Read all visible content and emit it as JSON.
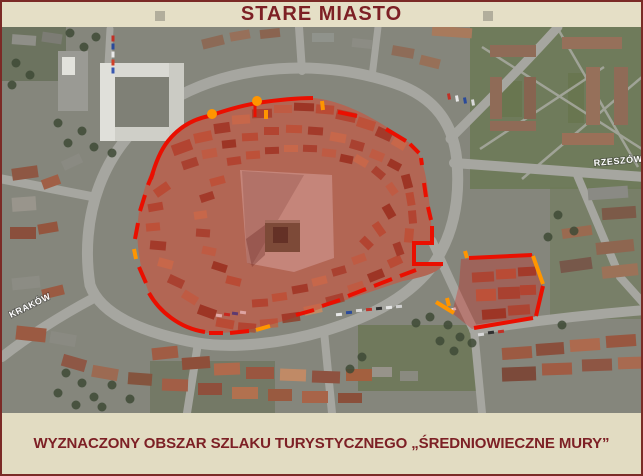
{
  "header": {
    "title": "STARE MIASTO"
  },
  "map": {
    "labels": {
      "krakow": "KRAKÓW",
      "rzeszow": "RZESZÓW"
    }
  },
  "footer": {
    "caption": "WYZNACZONY OBSZAR SZLAKU TURYSTYCZNEGO „ŚREDNIOWIECZNE MURY”"
  },
  "colors": {
    "frame_border": "#7b2a26",
    "panel_bg": "#e5dfc6",
    "title_text": "#7d2025",
    "boundary_red": "#ea0f00",
    "boundary_orange": "#ff9500",
    "area_tint": "rgba(214,22,16,0.30)"
  }
}
